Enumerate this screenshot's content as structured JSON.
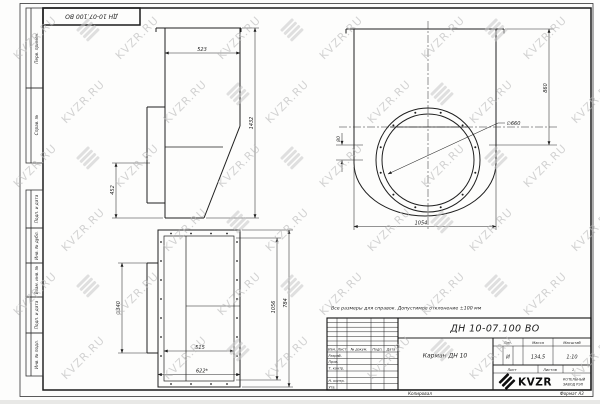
{
  "sheet": {
    "stamp_top_left": "ДН 10-07.100 ВО",
    "watermark": "KVZR.RU",
    "copied_label": "Копировал",
    "format_label": "Формат А3"
  },
  "colors": {
    "line": "#1f1f1f",
    "paper": "#fdfdfc",
    "watermark": "#b9b9b9"
  },
  "margin_labels": {
    "perv_primen": "Перв. примен.",
    "sprav_no": "Справ. №",
    "podp_data1": "Подп. и дата",
    "inv_dubl": "Инв. № дубл.",
    "vzam_inv": "Взам. инв. №",
    "podp_data2": "Подп. и дата",
    "inv_podl": "Инв. № подл."
  },
  "note": "Все размеры для справок. Допустимое отклонение  ±100 мм",
  "views": {
    "side": {
      "dim_width": "523",
      "dim_height": "1432",
      "dim_flange": "452"
    },
    "front": {
      "dim_height": "860",
      "dim_offset": "80",
      "dim_width": "1054",
      "dim_diameter": "∅660"
    },
    "bottom": {
      "dim_stub": "∅340",
      "dim_inner_width": "515",
      "dim_outer_width": "622*",
      "dim_inner_height": "1056",
      "dim_outer_height": "784"
    }
  },
  "title_block": {
    "designation": "ДН 10-07.100 ВО",
    "part_name": "Карман ДН 10",
    "columns": {
      "izm": "Изм.",
      "list": "Лист",
      "doc": "№ докум.",
      "podp": "Подп.",
      "data": "Дата"
    },
    "rows": {
      "razrab": "Разраб.",
      "prov": "Пров.",
      "t_kontr": "Т. контр.",
      "n_kontr": "Н. контр.",
      "utv": "Утв."
    },
    "lit_label": "Лит.",
    "lit_value": "И",
    "mass_label": "Масса",
    "mass_value": "134,5",
    "scale_label": "Масштаб",
    "scale_value": "1:10",
    "sheet_label": "Лист",
    "sheets_label": "Листов",
    "sheets_value": "1",
    "logo_text": "KVZR",
    "company_line1": "КОТЕЛЬНЫЙ",
    "company_line2": "ЗАВОД РЭП"
  }
}
